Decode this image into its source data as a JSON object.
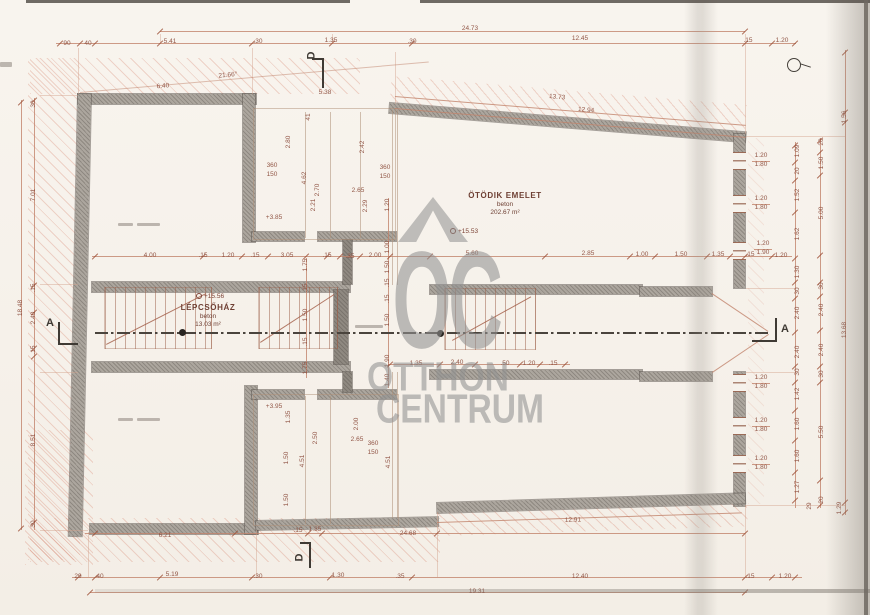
{
  "watermark": {
    "mark": "OC",
    "line2": "OTTHON",
    "line3": "CENTRUM"
  },
  "rooms": {
    "main": {
      "name": "ÖTÖDIK EMELET",
      "material": "beton",
      "area": "202.67 m²",
      "level": "+15.53"
    },
    "stairwell": {
      "name": "LÉPCSŐHÁZ",
      "material": "beton",
      "area": "13.03 m²",
      "level": "+15.56"
    }
  },
  "section_markers": {
    "a": "A",
    "d": "D"
  },
  "dims": [
    [
      "90",
      67,
      44,
      0
    ],
    [
      "40",
      88,
      44,
      0
    ],
    [
      "5.41",
      170,
      42,
      0
    ],
    [
      ".30",
      258,
      42,
      0
    ],
    [
      "1.35",
      331,
      41,
      0
    ],
    [
      "24.73",
      470,
      29,
      0
    ],
    [
      ".30",
      412,
      42,
      0
    ],
    [
      "12.45",
      580,
      39,
      0
    ],
    [
      ".15",
      748,
      41,
      0
    ],
    [
      "1.20",
      782,
      41,
      0
    ],
    [
      "21.66°",
      228,
      76,
      -5
    ],
    [
      "6.40",
      163,
      87,
      -4
    ],
    [
      "5.38",
      325,
      93,
      0
    ],
    [
      "13.73",
      557,
      98,
      5
    ],
    [
      "12.94",
      586,
      111,
      5
    ],
    [
      "41",
      309,
      117,
      -90
    ],
    [
      "2.80",
      289,
      142,
      -90
    ],
    [
      "2.42",
      363,
      147,
      -90
    ],
    [
      "360",
      272,
      166,
      0
    ],
    [
      "150",
      272,
      175,
      0
    ],
    [
      "360",
      385,
      168,
      0
    ],
    [
      "150",
      385,
      177,
      0
    ],
    [
      "4.62",
      305,
      178,
      -90
    ],
    [
      "2.70",
      318,
      190,
      -90
    ],
    [
      "2.65",
      358,
      191,
      0
    ],
    [
      "2.21",
      314,
      205,
      -90
    ],
    [
      "2.29",
      366,
      206,
      -90
    ],
    [
      "+3.85",
      274,
      218,
      0
    ],
    [
      "4.00",
      150,
      256,
      0
    ],
    [
      ".15",
      203,
      256,
      0
    ],
    [
      "1.20",
      228,
      256,
      0
    ],
    [
      ".15",
      255,
      256,
      0
    ],
    [
      "3.05",
      287,
      256,
      0
    ],
    [
      ".15",
      327,
      256,
      0
    ],
    [
      ".35",
      350,
      257,
      0
    ],
    [
      "2.00",
      375,
      256,
      0
    ],
    [
      "5.60",
      472,
      254,
      0
    ],
    [
      "2.85",
      588,
      254,
      0
    ],
    [
      "1.00",
      642,
      255,
      0
    ],
    [
      "1.50",
      681,
      255,
      0
    ],
    [
      "1.35",
      718,
      255,
      0
    ],
    [
      ".15",
      750,
      255,
      0
    ],
    [
      "1.20",
      781,
      256,
      0
    ],
    [
      "1.75",
      306,
      265,
      -90
    ],
    [
      ".15",
      306,
      288,
      -90
    ],
    [
      "1.50",
      306,
      315,
      -90
    ],
    [
      ".15",
      306,
      342,
      -90
    ],
    [
      "1.75",
      306,
      368,
      -90
    ],
    [
      "1.20",
      388,
      205,
      -90
    ],
    [
      "1.00",
      388,
      247,
      -90
    ],
    [
      "1.50",
      388,
      267,
      -90
    ],
    [
      ".15",
      388,
      283,
      -90
    ],
    [
      ".15",
      388,
      299,
      -90
    ],
    [
      "1.50",
      388,
      320,
      -90
    ],
    [
      "1.90",
      388,
      361,
      -90
    ],
    [
      "1.40",
      388,
      380,
      -90
    ],
    [
      "1.35",
      416,
      364,
      0
    ],
    [
      "2.40",
      457,
      363,
      0
    ],
    [
      ".50",
      505,
      364,
      0
    ],
    [
      "1.20",
      529,
      364,
      0
    ],
    [
      ".15",
      553,
      364,
      0
    ],
    [
      "+3.95",
      274,
      407,
      0
    ],
    [
      "1.35",
      289,
      417,
      -90
    ],
    [
      "2.00",
      357,
      424,
      -90
    ],
    [
      "2.50",
      316,
      438,
      -90
    ],
    [
      "2.65",
      357,
      440,
      0
    ],
    [
      "360",
      373,
      444,
      0
    ],
    [
      "150",
      373,
      453,
      0
    ],
    [
      "4.51",
      303,
      461,
      -90
    ],
    [
      "4.51",
      389,
      462,
      -90
    ],
    [
      "1.50",
      287,
      458,
      -90
    ],
    [
      "1.50",
      287,
      500,
      -90
    ],
    [
      "6.21",
      165,
      536,
      0
    ],
    [
      ".15",
      298,
      531,
      0
    ],
    [
      "1.35",
      315,
      530,
      0
    ],
    [
      "24.68",
      408,
      534,
      0
    ],
    [
      "12.91",
      573,
      521,
      -2
    ],
    [
      "29",
      78,
      577,
      0
    ],
    [
      "40",
      100,
      577,
      0
    ],
    [
      "5.19",
      172,
      575,
      0
    ],
    [
      ".30",
      258,
      577,
      0
    ],
    [
      "1.30",
      338,
      576,
      0
    ],
    [
      ".35",
      400,
      577,
      0
    ],
    [
      "12.40",
      580,
      577,
      0
    ],
    [
      ".15",
      750,
      577,
      0
    ],
    [
      "1.20",
      785,
      577,
      0
    ],
    [
      "19.31",
      477,
      592,
      0
    ],
    [
      "30",
      34,
      104,
      -90
    ],
    [
      "7.01",
      34,
      195,
      -90
    ],
    [
      ".15",
      34,
      288,
      -90
    ],
    [
      "2.40",
      34,
      318,
      -90
    ],
    [
      ".15",
      34,
      350,
      -90
    ],
    [
      "8.51",
      34,
      440,
      -90
    ],
    [
      "30",
      34,
      524,
      -90
    ],
    [
      "18.48",
      21,
      308,
      -90
    ],
    [
      "1.20",
      761,
      156,
      0
    ],
    [
      "1.80",
      761,
      165,
      0
    ],
    [
      "1.20",
      761,
      199,
      0
    ],
    [
      "1.80",
      761,
      208,
      0
    ],
    [
      "1.20",
      763,
      244,
      0
    ],
    [
      "1.90",
      763,
      253,
      0
    ],
    [
      "1.20",
      761,
      378,
      0
    ],
    [
      "1.80",
      761,
      387,
      0
    ],
    [
      "1.20",
      761,
      421,
      0
    ],
    [
      "1.80",
      761,
      430,
      0
    ],
    [
      "1.20",
      761,
      459,
      0
    ],
    [
      "1.80",
      761,
      468,
      0
    ],
    [
      "1.09",
      798,
      151,
      -90
    ],
    [
      "20",
      798,
      171,
      -90
    ],
    [
      "1.52",
      798,
      195,
      -90
    ],
    [
      "1.62",
      798,
      234,
      -90
    ],
    [
      "1.30",
      798,
      272,
      -90
    ],
    [
      "30",
      798,
      291,
      -90
    ],
    [
      "2.40",
      798,
      313,
      -90
    ],
    [
      "2.40",
      798,
      352,
      -90
    ],
    [
      "30",
      798,
      372,
      -90
    ],
    [
      "1.42",
      798,
      394,
      -90
    ],
    [
      "1.60",
      798,
      424,
      -90
    ],
    [
      "1.60",
      798,
      456,
      -90
    ],
    [
      "1.27",
      798,
      487,
      -90
    ],
    [
      "20",
      822,
      142,
      -90
    ],
    [
      "1.50",
      822,
      163,
      -90
    ],
    [
      "5.00",
      822,
      213,
      -90
    ],
    [
      "30",
      822,
      286,
      -90
    ],
    [
      "2.40",
      822,
      310,
      -90
    ],
    [
      "2.40",
      822,
      350,
      -90
    ],
    [
      "30",
      822,
      374,
      -90
    ],
    [
      "5.50",
      822,
      432,
      -90
    ],
    [
      "20",
      822,
      500,
      -90
    ],
    [
      "1.56",
      845,
      117,
      -90
    ],
    [
      "13.68",
      845,
      330,
      -90
    ],
    [
      "29",
      810,
      506,
      -90
    ],
    [
      "1.29",
      840,
      508,
      -90
    ]
  ]
}
